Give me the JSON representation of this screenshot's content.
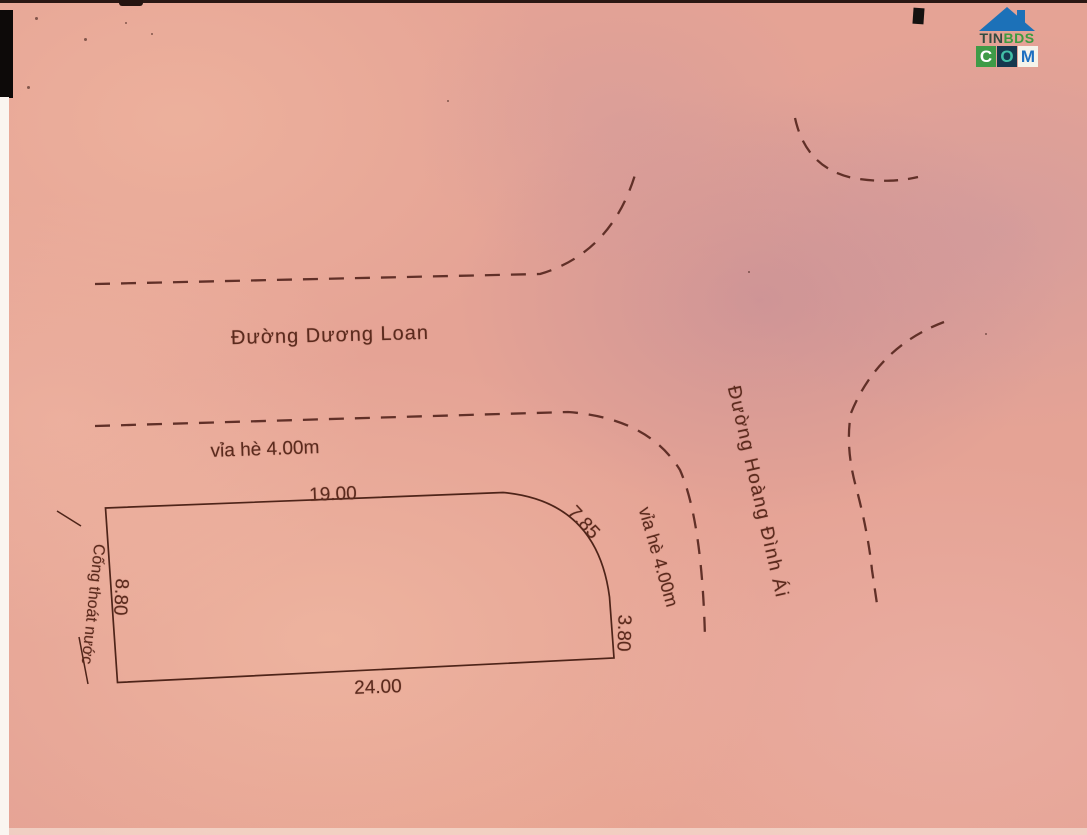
{
  "colors": {
    "ink": "#5b2a1d",
    "outline": "#4e2419",
    "dashed_road": "#613028",
    "paper_base": "#e5a395",
    "logo_blue": "#1c71b8",
    "logo_green": "#3f9b47",
    "logo_navy": "#16384e",
    "logo_teal": "#43bfa6",
    "logo_dark_text": "#344b41"
  },
  "logo": {
    "tin": "TIN",
    "bds": "BDS",
    "c": "C",
    "o": "O",
    "m": "M"
  },
  "streets": {
    "top": "Đường Dương Loan",
    "right": "Đường Hoàng Đình Ái"
  },
  "sidewalks": {
    "left": "vỉa hè 4.00m",
    "corner": "vỉa hè 4.00m"
  },
  "parcel": {
    "top": "19.00",
    "arc": "7.85",
    "right": "3.80",
    "bottom": "24.00",
    "left": "8.80",
    "drain": "Cống thoát nước"
  }
}
